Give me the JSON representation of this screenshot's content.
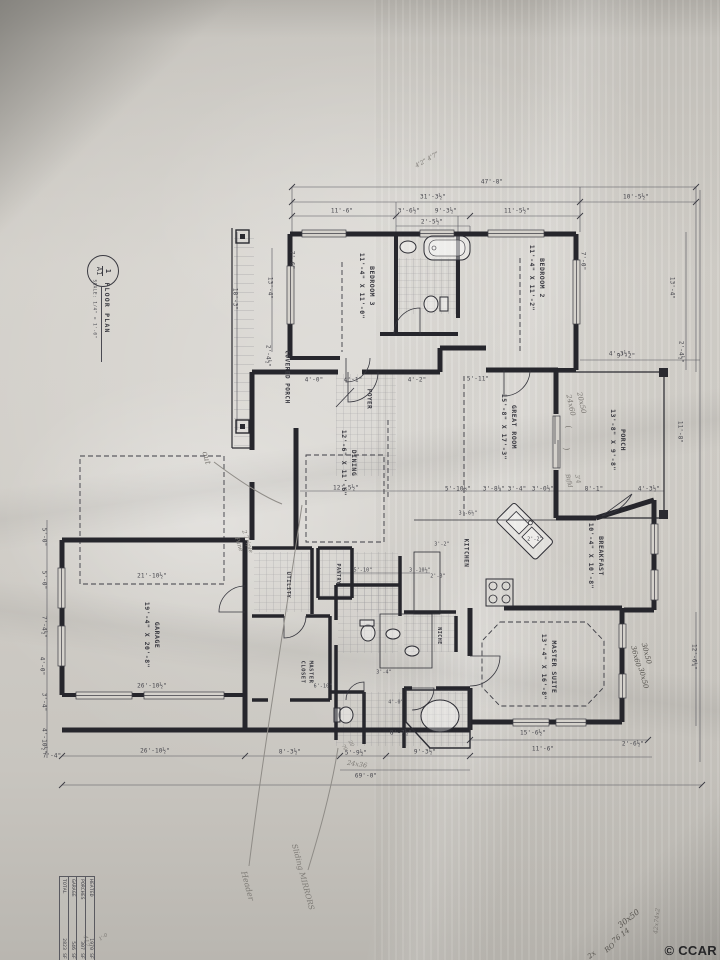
{
  "watermark": "© CCAR",
  "title_block": {
    "number": "1",
    "sheet": "A1",
    "title": "FLOOR PLAN",
    "scale": "SCALE: 1/4\" = 1'-0\""
  },
  "area_table": {
    "rows": [
      [
        "HEATED",
        "1970 SF"
      ],
      [
        "PORCHES",
        "307 SF"
      ],
      [
        "GARAGE",
        "546 SF"
      ],
      [
        "TOTAL",
        "2823 SF"
      ]
    ]
  },
  "labels": {
    "rooms": [
      {
        "t": "BEDROOM 3\n11'-4\" X 11'-0\"",
        "x": 366,
        "y": 286,
        "r": 90,
        "s": 6.5
      },
      {
        "t": "BEDROOM 2\n11'-4\" X 11'-2\"",
        "x": 536,
        "y": 278,
        "r": 90,
        "s": 6.5
      },
      {
        "t": "COVERED PORCH",
        "x": 287,
        "y": 377,
        "r": 90,
        "s": 6
      },
      {
        "t": "FOYER",
        "x": 369,
        "y": 399,
        "r": 90,
        "s": 6
      },
      {
        "t": "DINING\n12'-6\" X 11'-6\"",
        "x": 348,
        "y": 463,
        "r": 90,
        "s": 6.5
      },
      {
        "t": "GREAT ROOM\n15'-8\" X 17'-3\"",
        "x": 508,
        "y": 427,
        "r": 90,
        "s": 6.5
      },
      {
        "t": "PORCH\n13'-8\" X 9'-8\"",
        "x": 617,
        "y": 440,
        "r": 90,
        "s": 6.5
      },
      {
        "t": "KITCHEN",
        "x": 466,
        "y": 553,
        "r": 90,
        "s": 6
      },
      {
        "t": "BREAKFAST\n10'-4\" X 10'-8\"",
        "x": 595,
        "y": 556,
        "r": 90,
        "s": 6.5
      },
      {
        "t": "MASTER SUITE\n13'-4\" X 16'-8\"",
        "x": 548,
        "y": 667,
        "r": 90,
        "s": 6.5
      },
      {
        "t": "GARAGE\n19'-4\" X 20'-8\"",
        "x": 151,
        "y": 635,
        "r": 90,
        "s": 6.5
      },
      {
        "t": "UTILITY",
        "x": 288,
        "y": 585,
        "r": 90,
        "s": 5.5
      },
      {
        "t": "PANTRY",
        "x": 337,
        "y": 574,
        "r": 90,
        "s": 5
      },
      {
        "t": "MASTER\nCLOSET",
        "x": 306,
        "y": 672,
        "r": 90,
        "s": 5.5
      },
      {
        "t": "NICHE",
        "x": 438,
        "y": 636,
        "r": 90,
        "s": 5
      }
    ],
    "dimensions": [
      {
        "t": "47'-8\"",
        "x": 492,
        "y": 182
      },
      {
        "t": "31'-3½\"",
        "x": 433,
        "y": 197
      },
      {
        "t": "10'-5½\"",
        "x": 636,
        "y": 197
      },
      {
        "t": "11'-6\"",
        "x": 342,
        "y": 211
      },
      {
        "t": "3'-6½\"",
        "x": 409,
        "y": 211
      },
      {
        "t": "9'-3½\"",
        "x": 446,
        "y": 211
      },
      {
        "t": "11'-5½\"",
        "x": 517,
        "y": 211
      },
      {
        "t": "2'-5½\"",
        "x": 432,
        "y": 222
      },
      {
        "t": "7'-0\"",
        "x": 583,
        "y": 261,
        "r": 90
      },
      {
        "t": "13'-4\"",
        "x": 672,
        "y": 288,
        "r": 90
      },
      {
        "t": "9'-2\"",
        "x": 626,
        "y": 356
      },
      {
        "t": "2'-4½\"",
        "x": 681,
        "y": 352,
        "r": 90
      },
      {
        "t": "7'-6\"",
        "x": 292,
        "y": 260,
        "r": 90
      },
      {
        "t": "18'-3\"",
        "x": 235,
        "y": 299,
        "r": 90
      },
      {
        "t": "13'-4\"",
        "x": 270,
        "y": 288,
        "r": 90
      },
      {
        "t": "2'-4½\"",
        "x": 268,
        "y": 356,
        "r": 90
      },
      {
        "t": "11'-8\"",
        "x": 680,
        "y": 432,
        "r": 90
      },
      {
        "t": "4'-0\"",
        "x": 314,
        "y": 380
      },
      {
        "t": "4'-1\"",
        "x": 353,
        "y": 380
      },
      {
        "t": "4'-2\"",
        "x": 417,
        "y": 380
      },
      {
        "t": "5'-11\"",
        "x": 478,
        "y": 379
      },
      {
        "t": "4'-3½\"",
        "x": 620,
        "y": 354
      },
      {
        "t": "12'-5½\"",
        "x": 346,
        "y": 488
      },
      {
        "t": "5'-10½\"",
        "x": 458,
        "y": 489
      },
      {
        "t": "3'-8¼\"",
        "x": 494,
        "y": 489
      },
      {
        "t": "3'-4\"",
        "x": 517,
        "y": 489
      },
      {
        "t": "3'-0½\"",
        "x": 543,
        "y": 489
      },
      {
        "t": "8'-1\"",
        "x": 594,
        "y": 489
      },
      {
        "t": "4'-3½\"",
        "x": 649,
        "y": 489
      },
      {
        "t": "3'-6½\"",
        "x": 468,
        "y": 514,
        "s": 5
      },
      {
        "t": "2'-2\"",
        "x": 535,
        "y": 540,
        "s": 5
      },
      {
        "t": "3'-2\"",
        "x": 442,
        "y": 545,
        "s": 5
      },
      {
        "t": "2'-3\"",
        "x": 438,
        "y": 577,
        "s": 5
      },
      {
        "t": "5'-10\"",
        "x": 363,
        "y": 571,
        "s": 5
      },
      {
        "t": "3'-10½\"",
        "x": 420,
        "y": 571,
        "s": 5
      },
      {
        "t": "3'-4\"",
        "x": 384,
        "y": 673,
        "s": 5
      },
      {
        "t": "6'-10\"",
        "x": 323,
        "y": 687,
        "s": 5
      },
      {
        "t": "4'-0\"",
        "x": 396,
        "y": 703,
        "s": 5
      },
      {
        "t": "21'-10½\"",
        "x": 152,
        "y": 576
      },
      {
        "t": "26'-10½\"",
        "x": 152,
        "y": 686
      },
      {
        "t": "26'-10½\"",
        "x": 155,
        "y": 751
      },
      {
        "t": "5'-0\"",
        "x": 44,
        "y": 537,
        "r": 90
      },
      {
        "t": "5'-0\"",
        "x": 44,
        "y": 580,
        "r": 90
      },
      {
        "t": "7'-4½\"",
        "x": 44,
        "y": 627,
        "r": 90
      },
      {
        "t": "4'-0\"",
        "x": 42,
        "y": 666,
        "r": 90
      },
      {
        "t": "3'-4\"",
        "x": 44,
        "y": 702,
        "r": 90
      },
      {
        "t": "4'-10½\"",
        "x": 44,
        "y": 741,
        "r": 90
      },
      {
        "t": "7'-4\"",
        "x": 52,
        "y": 756
      },
      {
        "t": "8'-3½\"",
        "x": 290,
        "y": 752
      },
      {
        "t": "5'-9½\"",
        "x": 356,
        "y": 753
      },
      {
        "t": "9'-3½\"",
        "x": 425,
        "y": 752
      },
      {
        "t": "8'-7½\"",
        "x": 401,
        "y": 733
      },
      {
        "t": "69'-0\"",
        "x": 366,
        "y": 776
      },
      {
        "t": "15'-6½\"",
        "x": 533,
        "y": 733
      },
      {
        "t": "11'-6\"",
        "x": 543,
        "y": 749
      },
      {
        "t": "2'-6½\"",
        "x": 633,
        "y": 744
      },
      {
        "t": "12'-6¼\"",
        "x": 694,
        "y": 657,
        "r": 90
      }
    ],
    "handwritten": [
      {
        "t": "out",
        "x": 206,
        "y": 458,
        "r": 75,
        "s": 8
      },
      {
        "t": "4'2\" 4'7\"",
        "x": 427,
        "y": 160,
        "r": -30,
        "s": 6
      },
      {
        "t": "20x50\n24x60",
        "x": 576,
        "y": 404,
        "r": 78,
        "s": 7
      },
      {
        "t": "(",
        "x": 568,
        "y": 427,
        "r": 80,
        "s": 8
      },
      {
        "t": ")",
        "x": 566,
        "y": 449,
        "r": 80,
        "s": 8
      },
      {
        "t": "3'4\nBifld",
        "x": 573,
        "y": 480,
        "r": 78,
        "s": 6
      },
      {
        "t": "2 Triple\nPane",
        "x": 243,
        "y": 543,
        "r": 72,
        "s": 6
      },
      {
        "t": "30x50\n36x60",
        "x": 641,
        "y": 655,
        "r": 75,
        "s": 7,
        "d": 1
      },
      {
        "t": "30x50",
        "x": 643,
        "y": 678,
        "r": 75,
        "s": 7,
        "d": 1
      },
      {
        "t": "20\n70",
        "x": 347,
        "y": 746,
        "r": 60,
        "s": 5
      },
      {
        "t": "24x36",
        "x": 357,
        "y": 765,
        "r": 8,
        "s": 6.5
      },
      {
        "t": "Header",
        "x": 247,
        "y": 886,
        "r": 75,
        "s": 8
      },
      {
        "t": "Sliding MIRRORS",
        "x": 303,
        "y": 877,
        "r": 75,
        "s": 7.5
      },
      {
        "t": "30x50",
        "x": 629,
        "y": 919,
        "r": -38,
        "s": 8,
        "d": 1
      },
      {
        "t": "76 14",
        "x": 621,
        "y": 936,
        "r": -38,
        "s": 7,
        "d": 1
      },
      {
        "t": "RO",
        "x": 610,
        "y": 948,
        "r": -38,
        "s": 7,
        "d": 1
      },
      {
        "t": "2x",
        "x": 592,
        "y": 955,
        "r": -38,
        "s": 7,
        "d": 1
      },
      {
        "t": "42x74x2",
        "x": 657,
        "y": 921,
        "r": -85,
        "s": 6
      },
      {
        "t": "417",
        "x": 86,
        "y": 941,
        "r": 80,
        "s": 6
      },
      {
        "t": "1'-0",
        "x": 104,
        "y": 938,
        "r": -35,
        "s": 5
      }
    ]
  }
}
